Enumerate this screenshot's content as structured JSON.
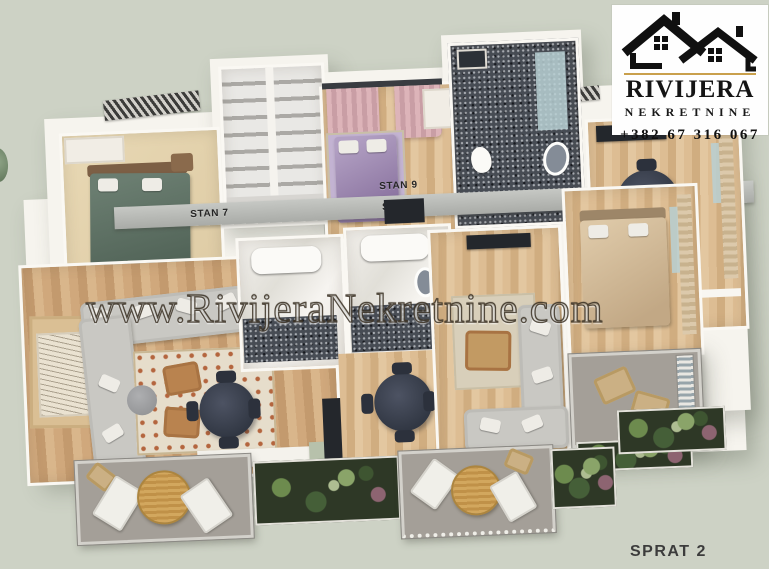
{
  "watermark": {
    "text": "www.RivijeraNekretnine.com"
  },
  "logo": {
    "title": "RIVIJERA",
    "subtitle": "NEKRETNINE",
    "phone": "+382 67 316 067",
    "icon": "houses-icon",
    "accent_color": "#c9a04c"
  },
  "floor_label": "SPRAT 2",
  "apartments": [
    {
      "id": "stan-7",
      "label": "STAN 7"
    },
    {
      "id": "stan-8",
      "label": "STAN 8"
    },
    {
      "id": "stan-9",
      "label": "STAN 9"
    }
  ],
  "scene": {
    "type": "3d-floorplan-render",
    "background_color": "#cdd2c5",
    "palette": {
      "wall_white": "#f6f4ee",
      "wood_floor": "#cda97e",
      "sofa_gray": "#c9c8c3",
      "bed_green": "#5c6f63",
      "bed_purple": "#9b86ae",
      "bed_tan": "#cfb690",
      "curtain_pink": "#d9aeb3",
      "tile_dark": "#474c54",
      "corridor_gray": "#b4b6b2",
      "table_navy": "#3d424e",
      "rug_terracotta": "#b4653e",
      "plant_green": "#4e6b3d",
      "deck_gray": "#a49f98"
    }
  }
}
